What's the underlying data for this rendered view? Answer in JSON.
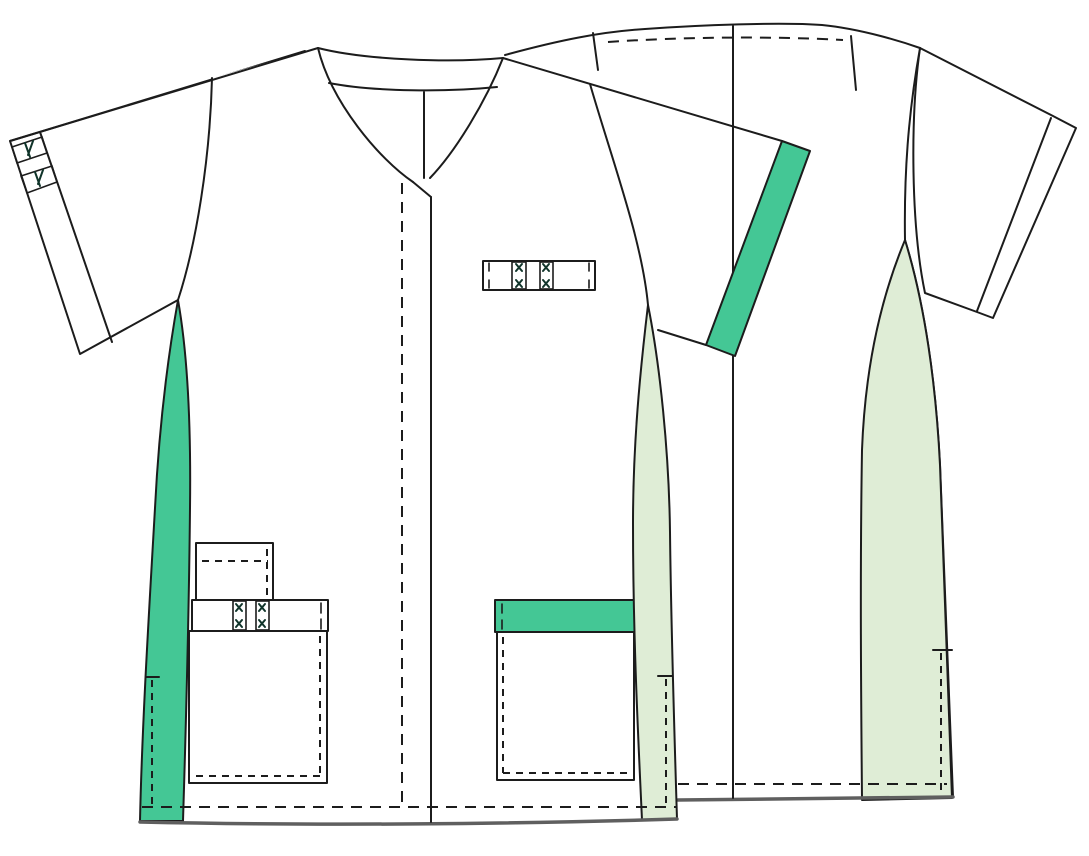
{
  "meta": {
    "description": "Technical flat sketch of a short-sleeve V-neck medical tunic shown as overlapping front and back views, no text labels",
    "views": [
      "front",
      "back"
    ]
  },
  "colors": {
    "background": "#ffffff",
    "outline": "#1c1c1c",
    "accent_green": "#44C795",
    "accent_light_green": "#DFEDD6",
    "hem_shadow": "#5f5f5f"
  },
  "parts": {
    "front": [
      "v-neckline with back-neck binding",
      "left sleeve with striped hem band",
      "right sleeve with solid green hem band",
      "green left side panel with vent",
      "light-green right side panel with vent",
      "chest pen pocket band with green and light-green stripes",
      "left small pocket",
      "left pocket band with stripes",
      "left large patch pocket",
      "right patch pocket with green top band",
      "center-front opening with dashed stitch line",
      "dashed hem stitch line"
    ],
    "back": [
      "back yoke dashed stitch line",
      "right sleeve with hem band",
      "light-green right side panel with vent",
      "left seam line",
      "dashed hem stitch line"
    ]
  }
}
